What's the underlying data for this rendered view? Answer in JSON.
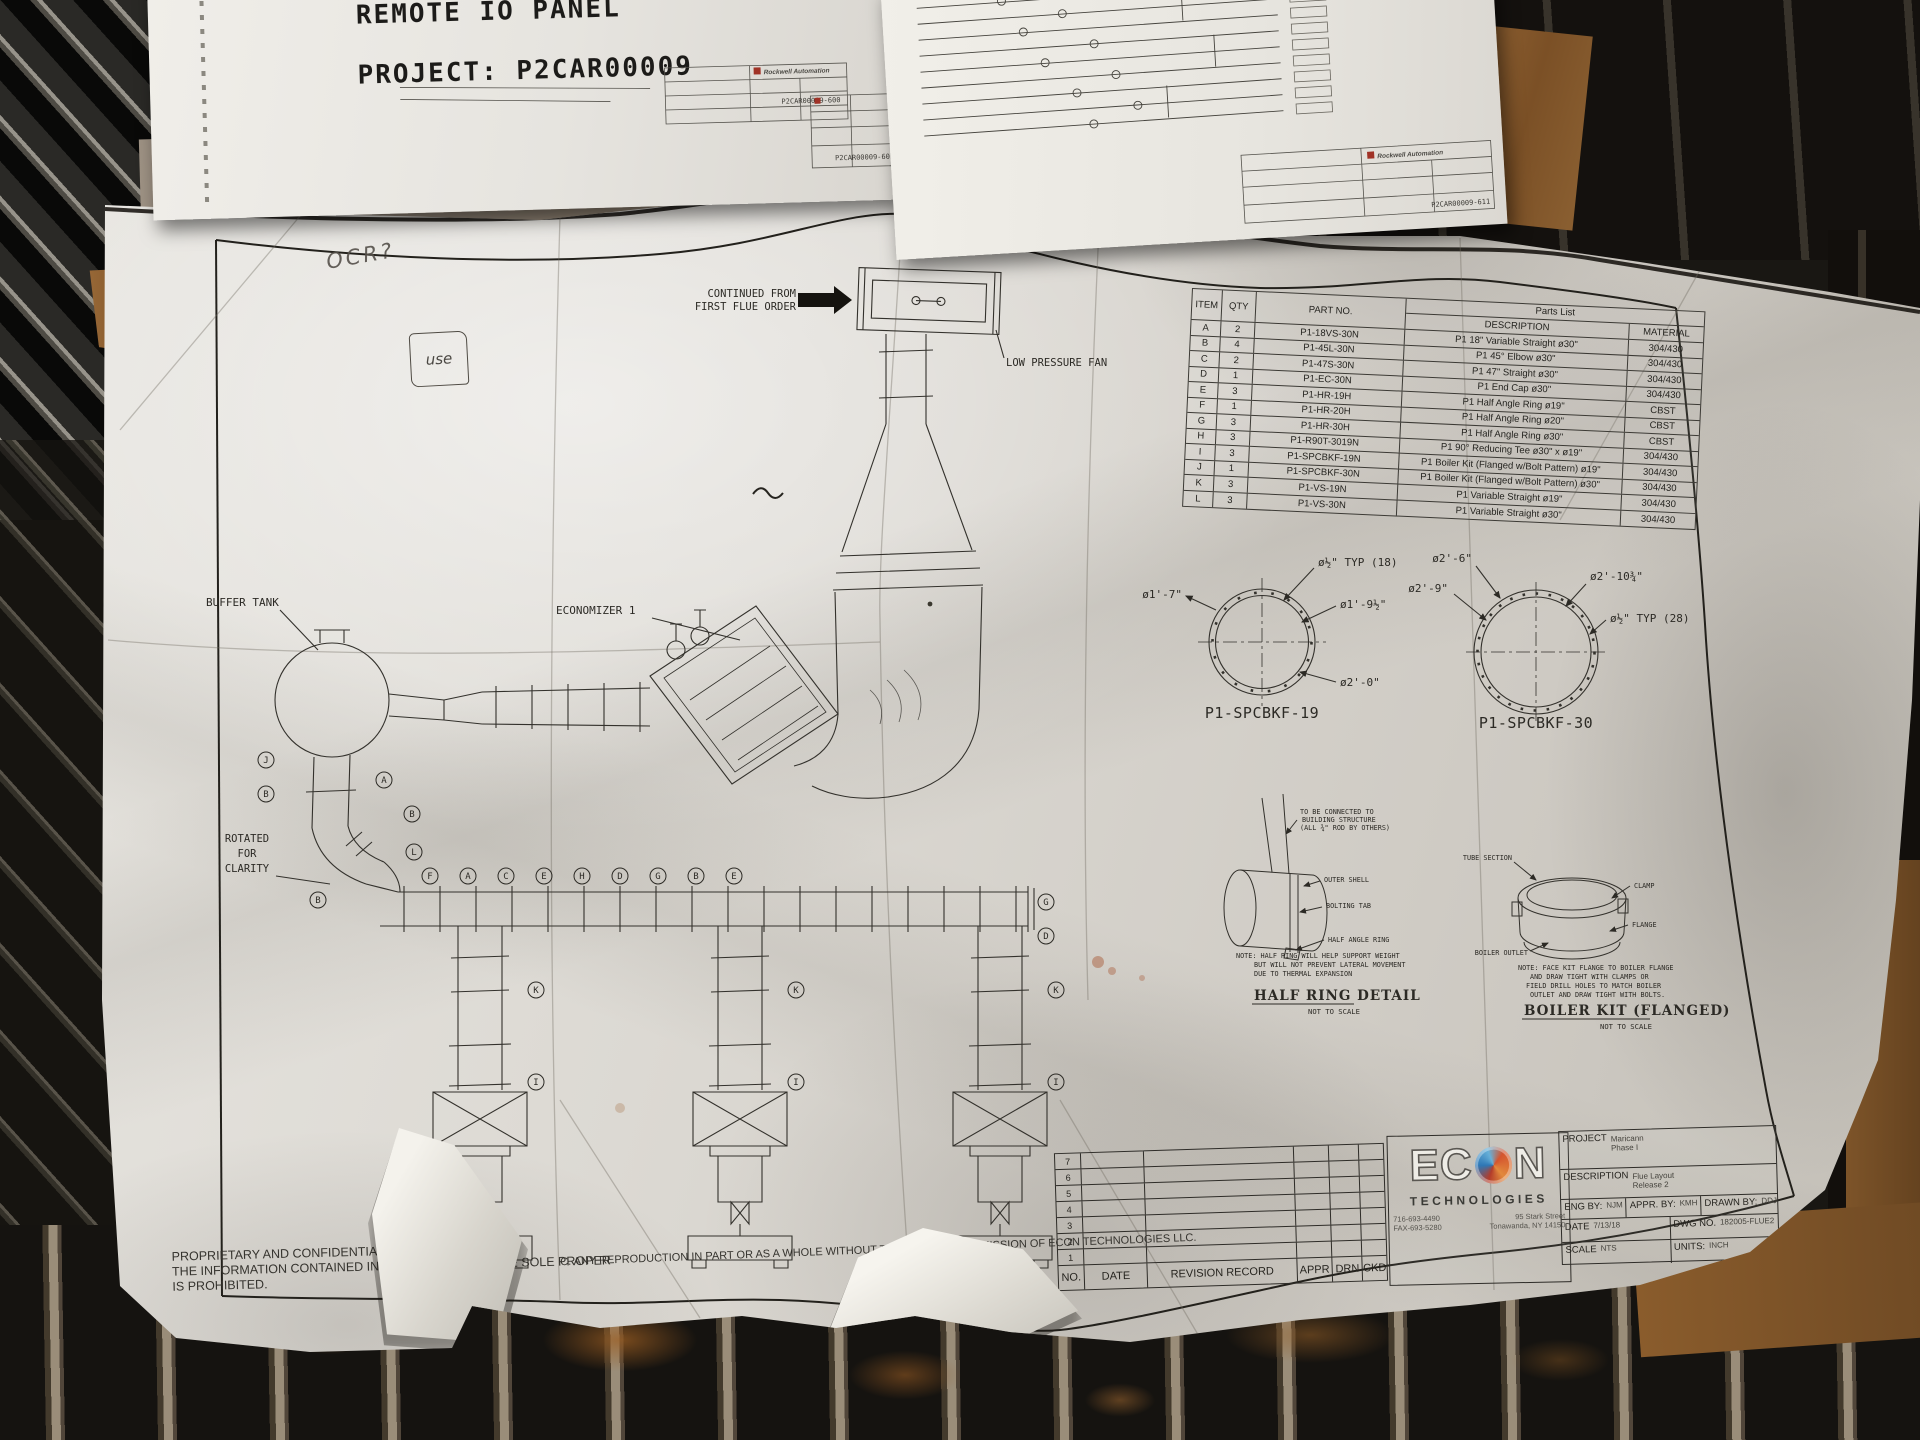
{
  "top_left_paper": {
    "partial_line": "IAS / PANEL",
    "title_line": "REMOTE IO PANEL",
    "project_line": "PROJECT: P2CAR00009",
    "brand": "Rockwell Automation",
    "sheet_no_1": "P2CAR00009-600",
    "sheet_no_2": "P2CAR00009-601"
  },
  "top_right_paper": {
    "brand": "Rockwell Automation",
    "sheet_no": "P2CAR00009-611"
  },
  "handwriting": {
    "mark1": "OCR?",
    "mark2": "use"
  },
  "flue_drawing": {
    "continued_1": "CONTINUED FROM",
    "continued_2": "FIRST FLUE ORDER",
    "low_pressure_fan": "LOW PRESSURE FAN",
    "buffer_tank": "BUFFER TANK",
    "economizer": "ECONOMIZER 1",
    "rotated_1": "ROTATED",
    "rotated_2": "FOR",
    "rotated_3": "CLARITY",
    "callouts": [
      "J",
      "B",
      "A",
      "B",
      "L",
      "B",
      "F",
      "A",
      "C",
      "E",
      "H",
      "D",
      "G",
      "B",
      "E",
      "G",
      "D",
      "K",
      "I",
      "K",
      "I",
      "K",
      "I"
    ]
  },
  "parts_list": {
    "title": "Parts List",
    "headers": {
      "item": "ITEM",
      "qty": "QTY",
      "part_no": "PART NO.",
      "description": "DESCRIPTION",
      "material": "MATERIAL"
    },
    "rows": [
      {
        "item": "A",
        "qty": "2",
        "part_no": "P1-18VS-30N",
        "description": "P1 18\" Variable Straight ø30\"",
        "material": "304/430"
      },
      {
        "item": "B",
        "qty": "4",
        "part_no": "P1-45L-30N",
        "description": "P1 45° Elbow ø30\"",
        "material": "304/430"
      },
      {
        "item": "C",
        "qty": "2",
        "part_no": "P1-47S-30N",
        "description": "P1 47\" Straight ø30\"",
        "material": "304/430"
      },
      {
        "item": "D",
        "qty": "1",
        "part_no": "P1-EC-30N",
        "description": "P1 End Cap ø30\"",
        "material": "304/430"
      },
      {
        "item": "E",
        "qty": "3",
        "part_no": "P1-HR-19H",
        "description": "P1 Half Angle Ring ø19\"",
        "material": "CBST"
      },
      {
        "item": "F",
        "qty": "1",
        "part_no": "P1-HR-20H",
        "description": "P1 Half Angle Ring ø20\"",
        "material": "CBST"
      },
      {
        "item": "G",
        "qty": "3",
        "part_no": "P1-HR-30H",
        "description": "P1 Half Angle Ring ø30\"",
        "material": "CBST"
      },
      {
        "item": "H",
        "qty": "3",
        "part_no": "P1-R90T-3019N",
        "description": "P1 90° Reducing Tee ø30\" x ø19\"",
        "material": "304/430"
      },
      {
        "item": "I",
        "qty": "3",
        "part_no": "P1-SPCBKF-19N",
        "description": "P1 Boiler Kit (Flanged w/Bolt Pattern) ø19\"",
        "material": "304/430"
      },
      {
        "item": "J",
        "qty": "1",
        "part_no": "P1-SPCBKF-30N",
        "description": "P1 Boiler Kit (Flanged w/Bolt Pattern) ø30\"",
        "material": "304/430"
      },
      {
        "item": "K",
        "qty": "3",
        "part_no": "P1-VS-19N",
        "description": "P1 Variable Straight ø19\"",
        "material": "304/430"
      },
      {
        "item": "L",
        "qty": "3",
        "part_no": "P1-VS-30N",
        "description": "P1 Variable Straight ø30\"",
        "material": "304/430"
      }
    ]
  },
  "detail_19": {
    "dim_a": "ø1'-7\"",
    "dim_bolt": "ø½\" TYP (18)",
    "dim_b": "ø1'-9½\"",
    "dim_c": "ø2'-0\"",
    "caption": "P1-SPCBKF-19"
  },
  "detail_30": {
    "dim_a": "ø2'-6\"",
    "dim_b": "ø2'-9\"",
    "dim_c": "ø2'-10¾\"",
    "dim_bolt": "ø½\" TYP (28)",
    "caption": "P1-SPCBKF-30"
  },
  "half_ring": {
    "rod_1": "TO BE CONNECTED TO",
    "rod_2": "BUILDING STRUCTURE",
    "rod_3": "(ALL ¾\" ROD BY OTHERS)",
    "shell": "OUTER SHELL",
    "tab": "BOLTING TAB",
    "ring": "HALF ANGLE RING",
    "note_1": "NOTE: HALF RING WILL HELP SUPPORT WEIGHT",
    "note_2": "BUT WILL NOT PREVENT LATERAL MOVEMENT",
    "note_3": "DUE TO THERMAL EXPANSION",
    "caption": "HALF RING DETAIL",
    "scale": "NOT TO SCALE"
  },
  "boiler_kit": {
    "tube": "TUBE SECTION",
    "clamp": "CLAMP",
    "flange": "FLANGE",
    "outlet": "BOILER OUTLET",
    "note_1": "NOTE: FACE KIT FLANGE TO BOILER FLANGE",
    "note_2": "AND DRAW TIGHT WITH CLAMPS OR",
    "note_3": "FIELD DRILL HOLES TO MATCH BOILER",
    "note_4": "OUTLET AND DRAW TIGHT WITH BOLTS.",
    "caption": "BOILER KIT (FLANGED)",
    "scale": "NOT TO SCALE"
  },
  "title_block": {
    "revision": {
      "numbers": [
        "7",
        "6",
        "5",
        "4",
        "3",
        "2",
        "1"
      ],
      "headers": {
        "no": "NO.",
        "date": "DATE",
        "record": "REVISION RECORD",
        "appr": "APPR",
        "drn": "DRN",
        "ckd": "CKD"
      }
    },
    "logo": {
      "e": "E",
      "c": "C",
      "n": "N",
      "technologies": "TECHNOLOGIES",
      "phone": "716-693-4490",
      "fax": "FAX-693-5280",
      "street": "95 Stark Street",
      "city": "Tonawanda, NY 14150"
    },
    "project_label": "PROJECT",
    "project_value1": "Maricann",
    "project_value2": "Phase I",
    "description_label": "DESCRIPTION",
    "description_value1": "Flue Layout",
    "description_value2": "Release 2",
    "eng_by_label": "ENG BY:",
    "eng_by": "NJM",
    "appr_by_label": "APPR. BY:",
    "appr_by": "KMH",
    "drawn_by_label": "DRAWN BY:",
    "drawn_by": "DDJ",
    "date_label": "DATE",
    "date": "7/13/18",
    "dwg_no_label": "DWG NO.",
    "dwg_no": "182005-FLUE2",
    "scale_label": "SCALE",
    "scale": "NTS",
    "units_label": "UNITS:",
    "units": "INCH"
  },
  "legal": {
    "line1": "PROPRIETARY AND CONFIDENTIAL",
    "line2": "THE INFORMATION CONTAINED IN THIS DRAWING IS THE SOLE PROPER",
    "line3": "IS PROHIBITED.",
    "continuation": "C. ANY REPRODUCTION IN PART OR AS A WHOLE WITHOUT THE WRITTEN PERMISSION OF ECON TECHNOLOGIES LLC."
  }
}
